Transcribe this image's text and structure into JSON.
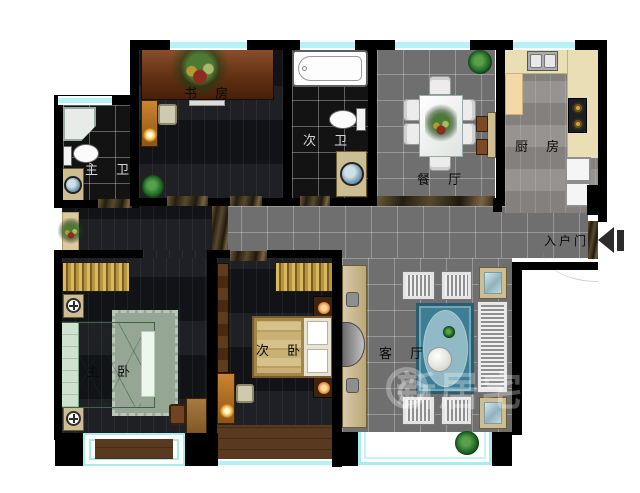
{
  "floorplan": {
    "title": "三室两厅户型平面图",
    "rooms": {
      "study": {
        "label": "书 房"
      },
      "bath_second": {
        "label": "次 卫"
      },
      "bath_master": {
        "label": "主 卫"
      },
      "dining": {
        "label": "餐 厅"
      },
      "kitchen": {
        "label": "厨 房"
      },
      "entrance": {
        "label": "入户门"
      },
      "bedroom_master": {
        "label": "主 卧"
      },
      "bedroom_second": {
        "label": "次 卧"
      },
      "living": {
        "label": "客 厅"
      }
    },
    "watermark": {
      "text": "新居宅配"
    },
    "colors": {
      "wall": "#000000",
      "window": "#b9f0f4",
      "tile_floor": "#6f6f6f",
      "dark_wood_floor": "#16171a",
      "bathroom_tile": "#131313",
      "kitchen_counter": "#eadfb4",
      "marble_threshold": "#57492e",
      "master_bed": "#a3cbaa",
      "second_bed": "#c6ad74",
      "living_rug": "#3e7e95",
      "accent_wood": "#b06f1f"
    }
  }
}
